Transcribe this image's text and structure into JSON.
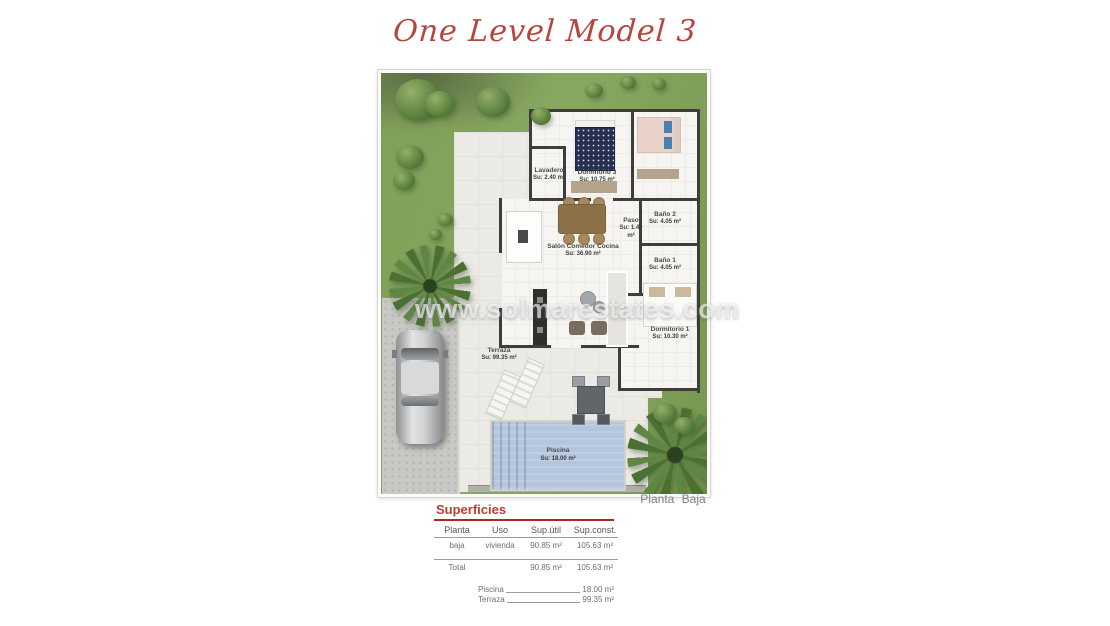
{
  "page": {
    "title": "One Level Model 3",
    "watermark": "www.solmarestates.com",
    "caption": "Planta Baja"
  },
  "colors": {
    "accent_red": "#b5453e",
    "grass_green": "#7fa058",
    "pool_blue": "#b4c6de",
    "wall_dark": "#3f3d3a",
    "terrace_gray": "#eceae5"
  },
  "floor_plan": {
    "rooms": [
      {
        "id": "lavadero",
        "name": "Lavadero",
        "area": "Su: 2.40 m²"
      },
      {
        "id": "dormitorio3",
        "name": "Dormitorio 3",
        "area": "Su: 10.75 m²"
      },
      {
        "id": "salon",
        "name": "Salón Comedor Cocina",
        "area": "Su: 36.90 m²"
      },
      {
        "id": "paso",
        "name": "Paso",
        "area": "Su: 1.40 m²"
      },
      {
        "id": "bano2",
        "name": "Baño 2",
        "area": "Su: 4.05 m²"
      },
      {
        "id": "bano1",
        "name": "Baño 1",
        "area": "Su: 4.05 m²"
      },
      {
        "id": "dormitorio1",
        "name": "Dormitorio 1",
        "area": "Su: 10.30 m²"
      },
      {
        "id": "terraza",
        "name": "Terraza",
        "area": "Su: 99.35 m²"
      },
      {
        "id": "piscina",
        "name": "Piscina",
        "area": "Su: 18.00 m²"
      }
    ]
  },
  "surfaces": {
    "heading": "Superficies",
    "columns": [
      "Planta",
      "Uso",
      "Sup.útil",
      "Sup.const."
    ],
    "row": {
      "planta": "baja",
      "uso": "vivienda",
      "sup_util": "90.85 m²",
      "sup_const": "105.63 m²"
    },
    "total": {
      "label": "Total",
      "sup_util": "90.85 m²",
      "sup_const": "105.63 m²"
    },
    "extras": [
      {
        "label": "Piscina",
        "value": "18.00 m²"
      },
      {
        "label": "Terraza",
        "value": "99.35 m²"
      }
    ]
  }
}
